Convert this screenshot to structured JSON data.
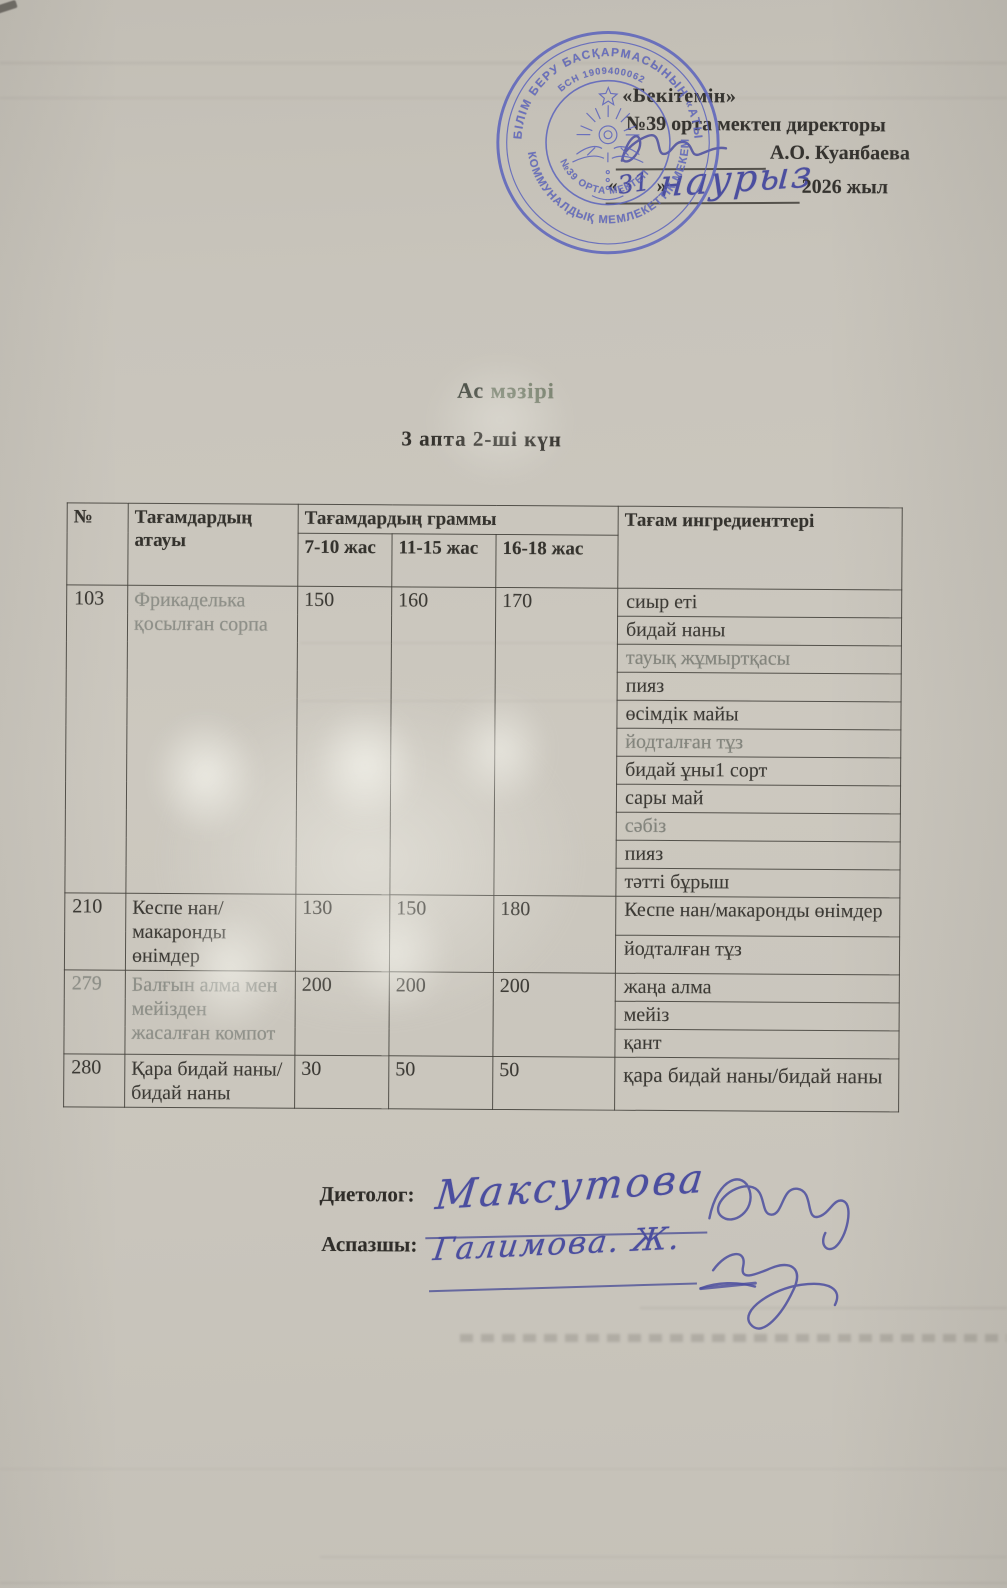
{
  "palette": {
    "paper": "#c8c4bb",
    "stamp_blue": "#5b63bd",
    "ink_blue": "#4b4e9f",
    "print_black": "#35332f"
  },
  "approval": {
    "line1": "«Бекітемін»",
    "line2": "№39 орта мектеп директоры",
    "director_name": "А.О. Куанбаева",
    "date_open_quote": "«",
    "date_close_quote": "»",
    "handwritten_day": "31",
    "handwritten_month": "наурыз",
    "year_text": "2026 жыл"
  },
  "stamp": {
    "ring_text_top": "БІЛІМ БЕРУ БАСҚАРМАСЫНЫҢ «АТЫРАУ",
    "ring_text_bottom": "КОММУНАЛДЫҚ МЕМЛЕКЕТТІК МЕКЕМЕСІ",
    "bin_text": "БСН 1909400062",
    "school_text": "№39 ОРТА МЕКТЕП"
  },
  "title": {
    "word1": "Ас",
    "word2": "мәзірі"
  },
  "subtitle": "3 апта 2-ші күн",
  "table": {
    "headers": {
      "num": "№",
      "name": "Тағамдардың атауы",
      "grams": "Тағамдардың  граммы",
      "age1": "7-10 жас",
      "age2": "11-15 жас",
      "age3": "16-18 жас",
      "ingredients": "Тағам ингредиенттері"
    },
    "rows": [
      {
        "num": "103",
        "name": "Фрикаделька қосылған сорпа",
        "grams": [
          "150",
          "160",
          "170"
        ],
        "ingredients": [
          "сиыр еті",
          "бидай наны",
          "тауық жұмыртқасы",
          "пияз",
          "өсімдік майы",
          "йодталған тұз",
          "бидай ұны1 сорт",
          "сары май",
          "сәбіз",
          "пияз",
          "тәтті бұрыш"
        ]
      },
      {
        "num": "210",
        "name": "Кеспе нан/макаронды өнімдер",
        "grams": [
          "130",
          "150",
          "180"
        ],
        "ingredients": [
          "Кеспе нан/макаронды өнімдер",
          "йодталған тұз"
        ]
      },
      {
        "num": "279",
        "name": "Балғын алма мен мейізден жасалған компот",
        "grams": [
          "200",
          "200",
          "200"
        ],
        "ingredients": [
          "жаңа алма",
          "мейіз",
          "қант"
        ]
      },
      {
        "num": "280",
        "name": "Қара бидай наны/бидай наны",
        "grams": [
          "30",
          "50",
          "50"
        ],
        "ingredients": [
          "қара бидай наны/бидай наны"
        ]
      }
    ]
  },
  "signatures": {
    "dietolog_label": "Диетолог:",
    "dietolog_name": "Максутова",
    "cook_label": "Аспазшы:",
    "cook_name": "Галимова. Ж."
  }
}
